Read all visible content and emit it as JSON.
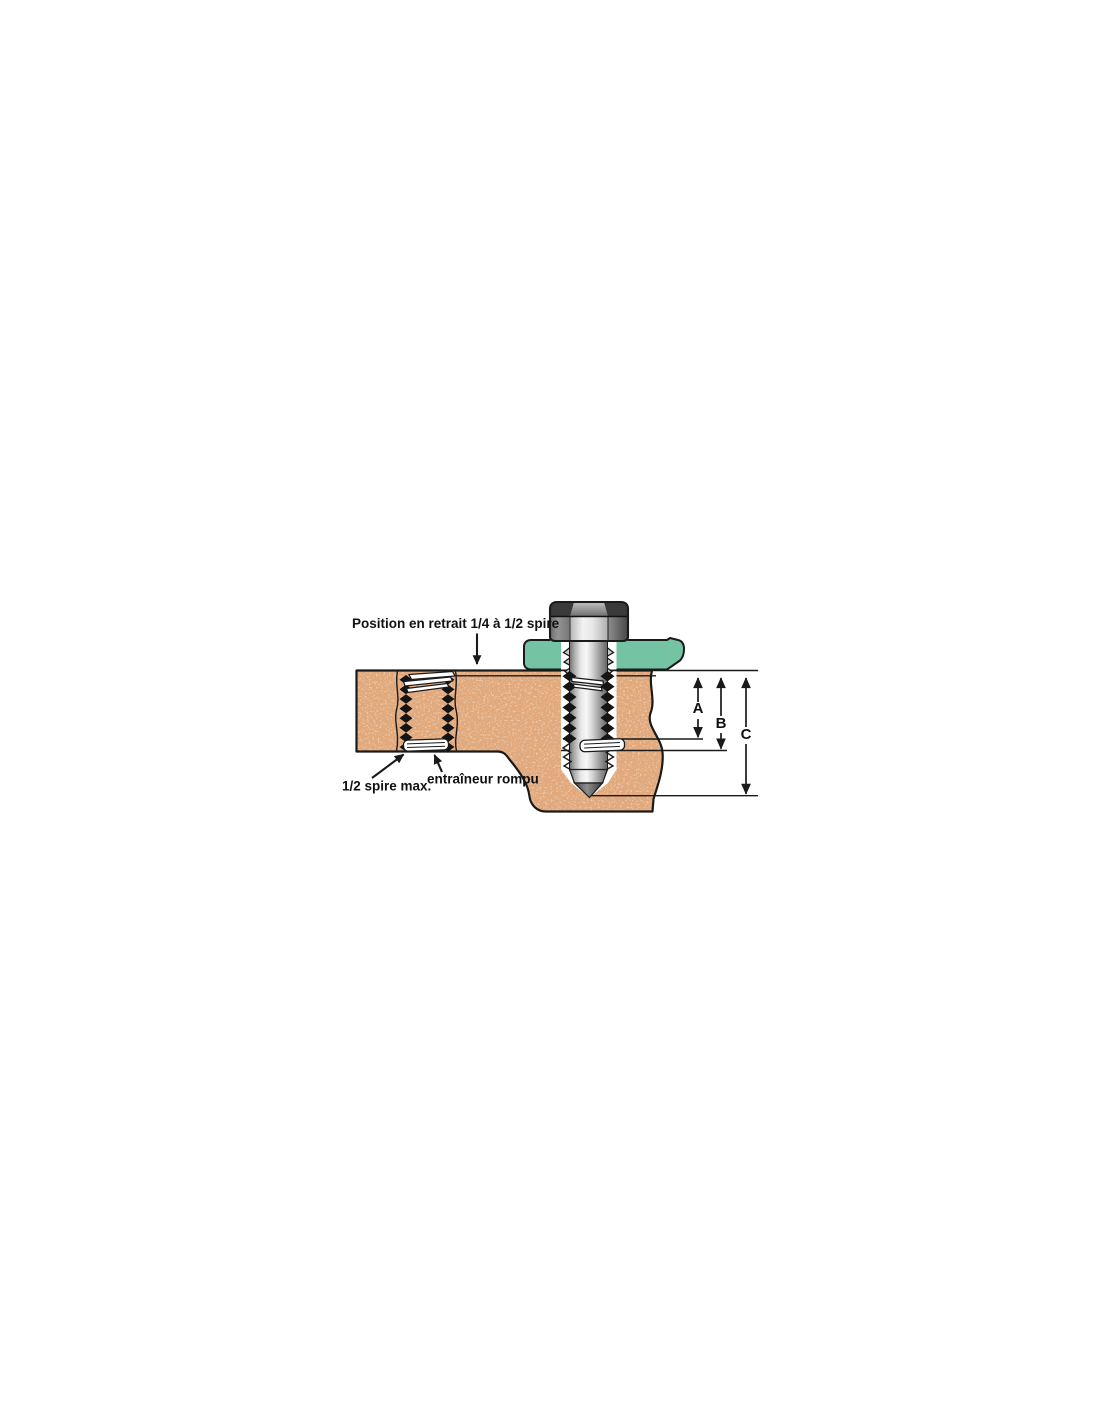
{
  "diagram": {
    "labels": {
      "position": "Position en retrait 1/4 à 1/2 spire",
      "half_spire": "1/2 spire max.",
      "tang": "entraîneur rompu"
    },
    "dimensions": {
      "a": "A",
      "b": "B",
      "c": "C"
    },
    "colors": {
      "material": "#e2a87a",
      "material_speckle_dark": "#b27048",
      "material_speckle_light": "#f6ddc2",
      "plate": "#74c4a3",
      "outline": "#1a1a1a",
      "metal_light": "#f2f2f2",
      "metal_dark": "#5a5a5a"
    }
  }
}
